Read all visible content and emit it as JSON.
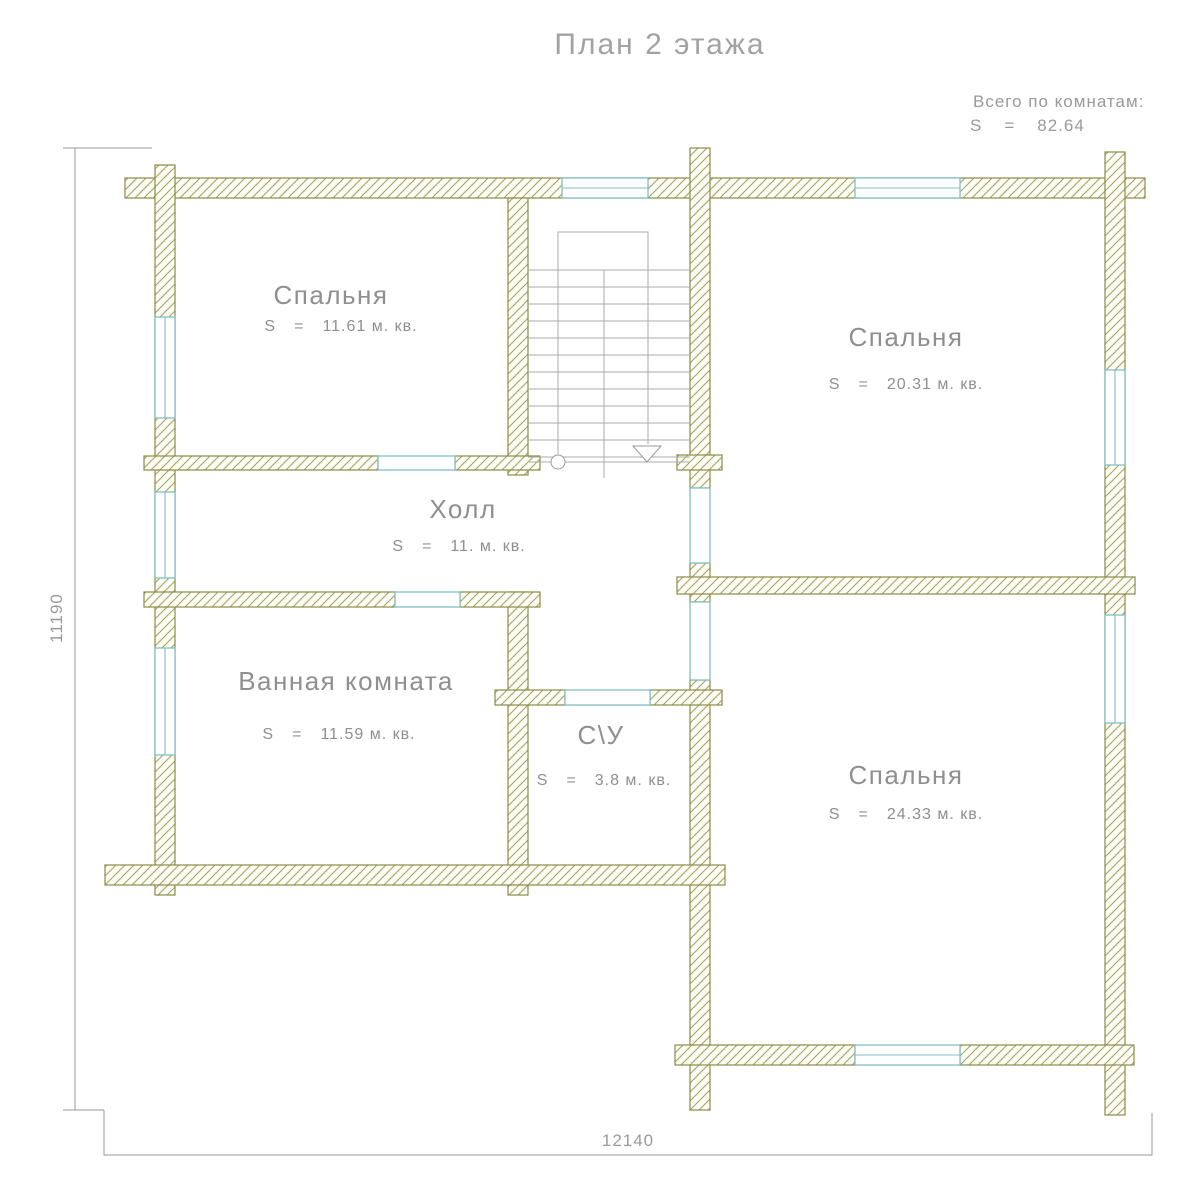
{
  "title": "План 2 этажа",
  "summary": {
    "label": "Всего по комнатам:",
    "s_label": "S",
    "equals": "=",
    "total": "82.64"
  },
  "rooms": [
    {
      "name": "Спальня",
      "s": "S",
      "eq": "=",
      "area": "11.61 м. кв."
    },
    {
      "name": "Спальня",
      "s": "S",
      "eq": "=",
      "area": "20.31 м. кв."
    },
    {
      "name": "Холл",
      "s": "S",
      "eq": "=",
      "area": "11. м. кв."
    },
    {
      "name": "Ванная комната",
      "s": "S",
      "eq": "=",
      "area": "11.59 м. кв."
    },
    {
      "name": "С\\У",
      "s": "S",
      "eq": "=",
      "area": "3.8 м. кв."
    },
    {
      "name": "Спальня",
      "s": "S",
      "eq": "=",
      "area": "24.33 м. кв."
    }
  ],
  "dimensions": {
    "height": "11190",
    "width": "12140"
  },
  "colors": {
    "wall_outline": "#8b8b47",
    "wall_hatch": "#a3a363",
    "window": "#7fbfc4",
    "text": "#8f8f8f"
  }
}
